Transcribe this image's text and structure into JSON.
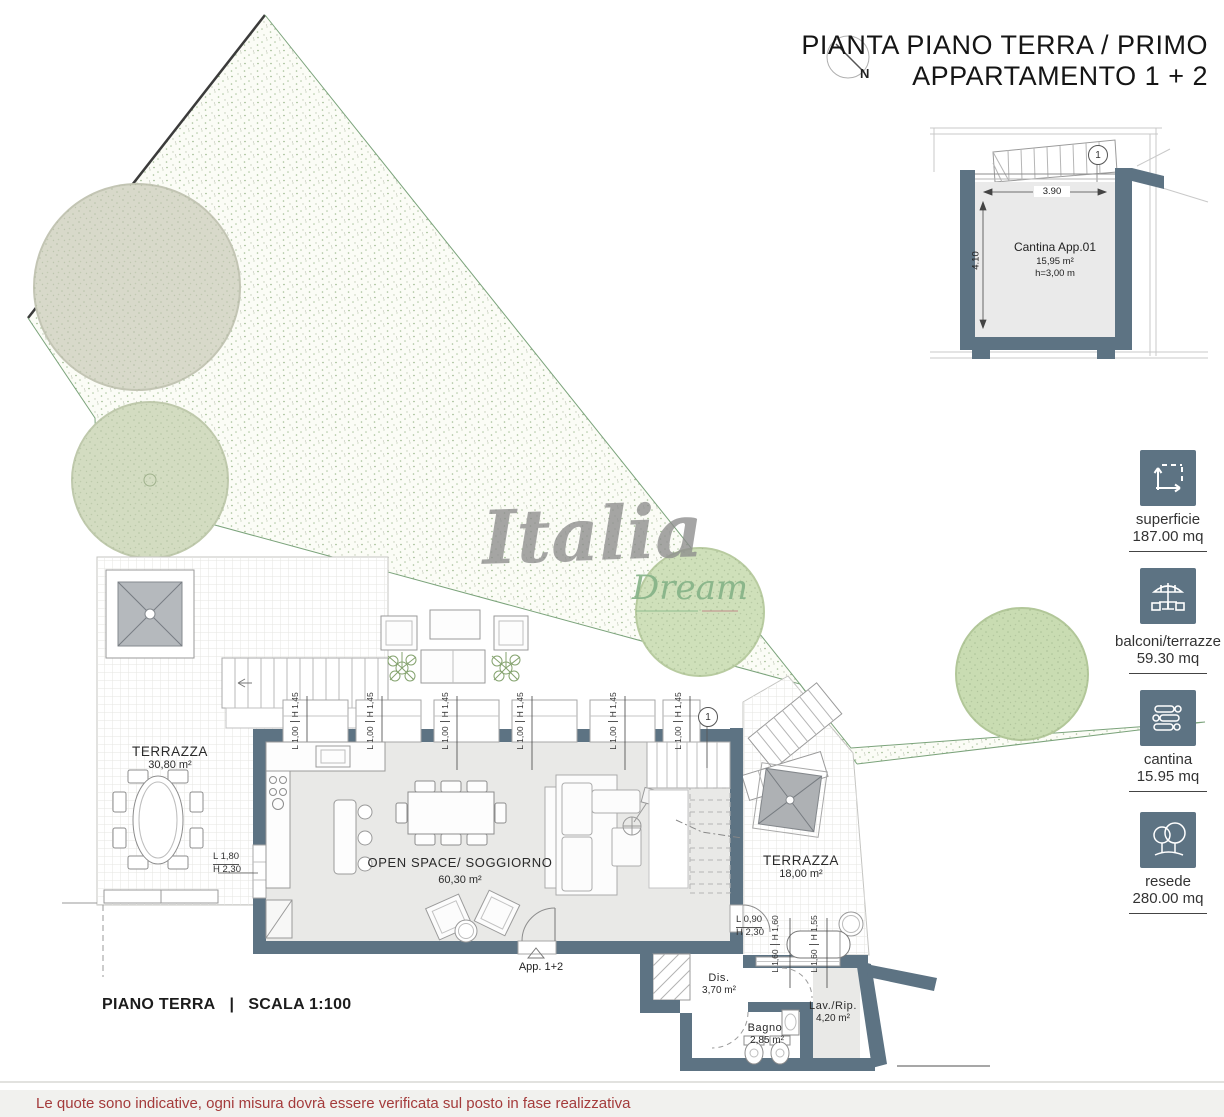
{
  "title": {
    "line1": "PIANTA PIANO TERRA / PRIMO",
    "line2": "APPARTAMENTO 1 + 2"
  },
  "north": {
    "label": "N"
  },
  "watermark": {
    "line1": "Italia",
    "line2": "Dream"
  },
  "inset": {
    "room_name": "Cantina App.01",
    "area": "15,95 m²",
    "height": "h=3,00 m",
    "dim_width": "3.90",
    "dim_height": "4.10",
    "marker": "1"
  },
  "legend": {
    "items": [
      {
        "icon": "area-icon",
        "label": "superficie",
        "value": "187.00 mq"
      },
      {
        "icon": "terrace-icon",
        "label": "balconi/terrazze",
        "value": "59.30 mq"
      },
      {
        "icon": "cellar-icon",
        "label": "cantina",
        "value": "15.95 mq"
      },
      {
        "icon": "garden-icon",
        "label": "resede",
        "value": "280.00 mq"
      }
    ]
  },
  "rooms": {
    "terrace_left": {
      "name": "TERRAZZA",
      "area": "30,80 m²"
    },
    "open_space": {
      "name": "OPEN SPACE/ SOGGIORNO",
      "area": "60,30 m²"
    },
    "terrace_right": {
      "name": "TERRAZZA",
      "area": "18,00 m²"
    },
    "dis": {
      "name": "Dis.",
      "area": "3,70 m²"
    },
    "bagno": {
      "name": "Bagno",
      "area": "2,85 m²"
    },
    "lav": {
      "name": "Lav./Rip.",
      "area": "4,20 m²"
    }
  },
  "doors": {
    "entrance_label": "App. 1+2",
    "marker": "1"
  },
  "dims": {
    "window": {
      "l": "L 1,00",
      "h": "H 1,45"
    },
    "door_left": {
      "l": "L 1,80",
      "h": "H 2,30"
    },
    "door_terrace": {
      "l": "L 0,90",
      "h": "H 2,30"
    },
    "boiler_a": {
      "l": "L 1,60",
      "h": "H 1,60"
    },
    "boiler_b": {
      "l": "L 1,60",
      "h": "H 1,55"
    }
  },
  "footer": {
    "plan_label": "PIANO TERRA",
    "separator": "|",
    "scale_label": "SCALA 1:100",
    "disclaimer": "Le quote sono indicative, ogni misura dovrà essere verificata sul posto in fase realizzativa"
  },
  "colors": {
    "wall": "#5d7383",
    "accent_red": "#a43b3b"
  }
}
